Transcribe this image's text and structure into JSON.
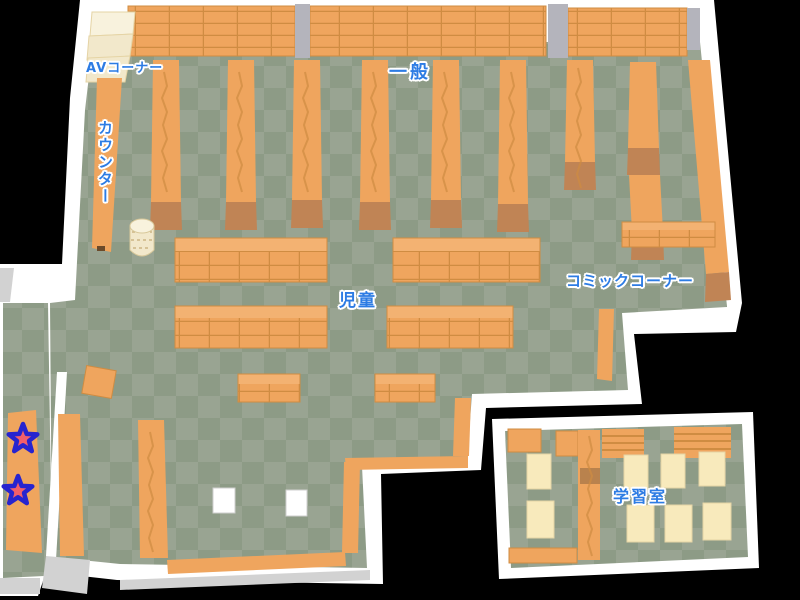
{
  "map": {
    "regions": {
      "av_corner": "AVコーナー",
      "general": "一般",
      "counter": "カウンター",
      "children": "児童",
      "comic_corner": "コミックコーナー",
      "study_room": "学習室"
    },
    "markers": {
      "icon": "star-icon",
      "count": 2
    }
  },
  "colors": {
    "bg": "#000000",
    "wall": "#ffffff",
    "wall_shadow": "#d2d2d2",
    "floor_light": "#99a492",
    "floor_dark": "#8d9b86",
    "shelf": "#efa55e",
    "shelf_top": "#f3b272",
    "shelf_line": "#cf8c42",
    "shelf_foot": "#c08455",
    "pillar": "#b4b4bc",
    "cream": "#f2e8cb",
    "cream_light": "#f8f2dd",
    "desk": "#f8eabc",
    "desk_edge": "#e5d4a5",
    "label_blue": "#2d7ce4",
    "star_fill": "#f25f6a",
    "star_stroke": "#2724cf"
  }
}
